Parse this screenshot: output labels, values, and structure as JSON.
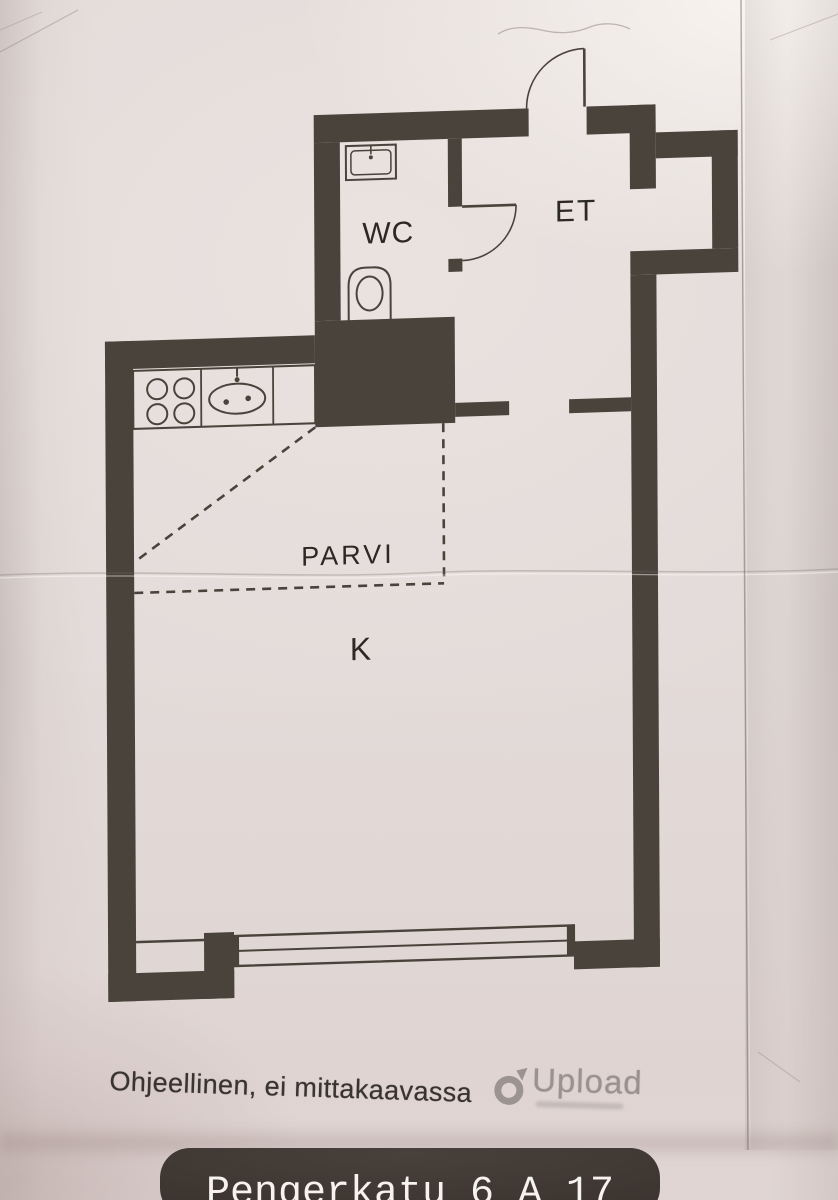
{
  "plan": {
    "rooms": {
      "wc": "WC",
      "et": "ET",
      "parvi": "PARVI",
      "k": "K"
    }
  },
  "footer": {
    "disclaimer": "Ohjeellinen, ei mittakaavassa",
    "watermark_brand": "Upload"
  },
  "address_bar": {
    "text": "Pengerkatu 6 A 17"
  },
  "colors": {
    "wall": "#4a433b",
    "paper": "#e3dbd9",
    "label_text": "#2c2824",
    "address_bar_background": "#423a35",
    "address_bar_text": "#f6f2ee",
    "watermark_gray": "#8a827d"
  }
}
